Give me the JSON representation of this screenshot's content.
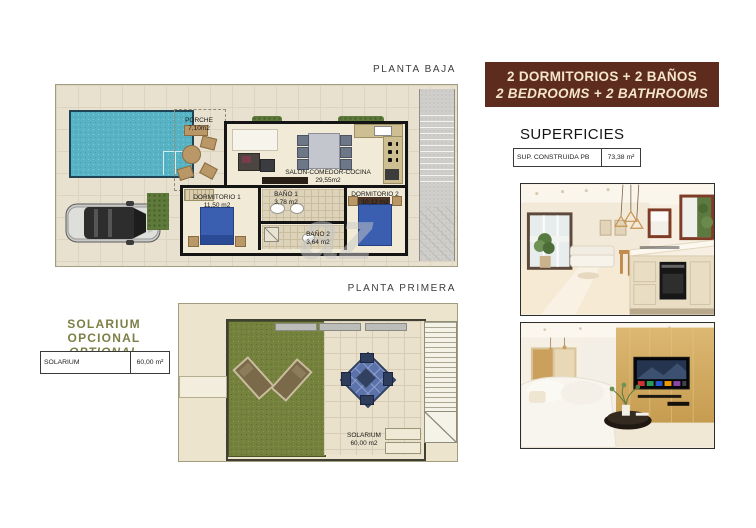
{
  "planta_baja": {
    "title": "PLANTA BAJA",
    "watermark": "az",
    "rooms": {
      "porche": {
        "name": "PORCHE",
        "area": "7,10m2"
      },
      "salon": {
        "name": "SALON-COMEDOR-COCINA",
        "area": "29,55m2"
      },
      "dormitorio1": {
        "name": "DORMITORIO 1",
        "area": "11,50 m2"
      },
      "bano1": {
        "name": "BAÑO 1",
        "area": "3,78 m2"
      },
      "bano2": {
        "name": "BAÑO 2",
        "area": "3,64 m2"
      },
      "dormitorio2": {
        "name": "DORMITORIO 2",
        "area": "10,12 m2"
      }
    }
  },
  "planta_primera": {
    "title": "PLANTA PRIMERA",
    "solarium": {
      "name": "SOLARIUM",
      "area": "60,00 m2"
    }
  },
  "banner": {
    "line1": "2 DORMITORIOS + 2 BAÑOS",
    "line2": "2 BEDROOMS + 2 BATHROOMS",
    "bg_color": "#5E2B1F",
    "text_color": "#F4E6C9"
  },
  "superficies": {
    "heading": "SUPERFICIES",
    "table": {
      "label": "SUP. CONSTRUIDA PB",
      "value": "73,38 m²"
    }
  },
  "solarium_optional": {
    "line_es": "SOLARIUM OPCIONAL",
    "line_en": "OPTIONAL SOLARIUM",
    "accent_color": "#7C8045",
    "table": {
      "label": "SOLARIUM",
      "value": "60,00 m²"
    }
  },
  "photos": {
    "photo1": "kitchen-living-room-render",
    "photo2": "living-room-tv-render"
  }
}
